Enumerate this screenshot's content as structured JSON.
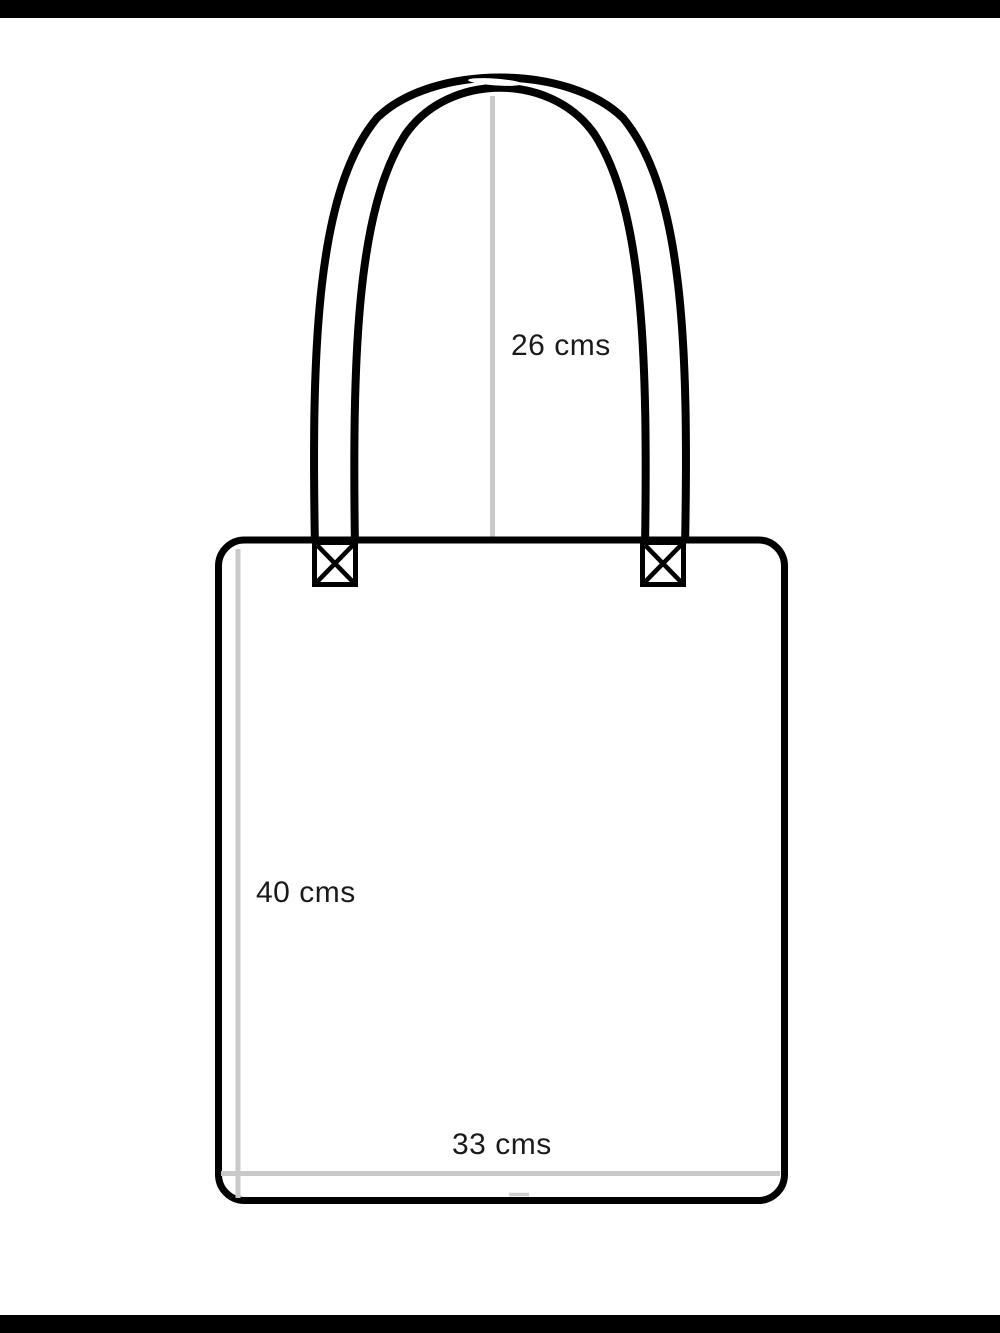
{
  "diagram": {
    "measurements": {
      "handle_height": "26 cms",
      "bag_height": "40 cms",
      "bag_width": "33 cms"
    },
    "colors": {
      "outline": "#000000",
      "measure_line": "#c9c9c9",
      "text": "#1a1a1a",
      "background": "#ffffff",
      "letterbox": "#000000"
    }
  }
}
